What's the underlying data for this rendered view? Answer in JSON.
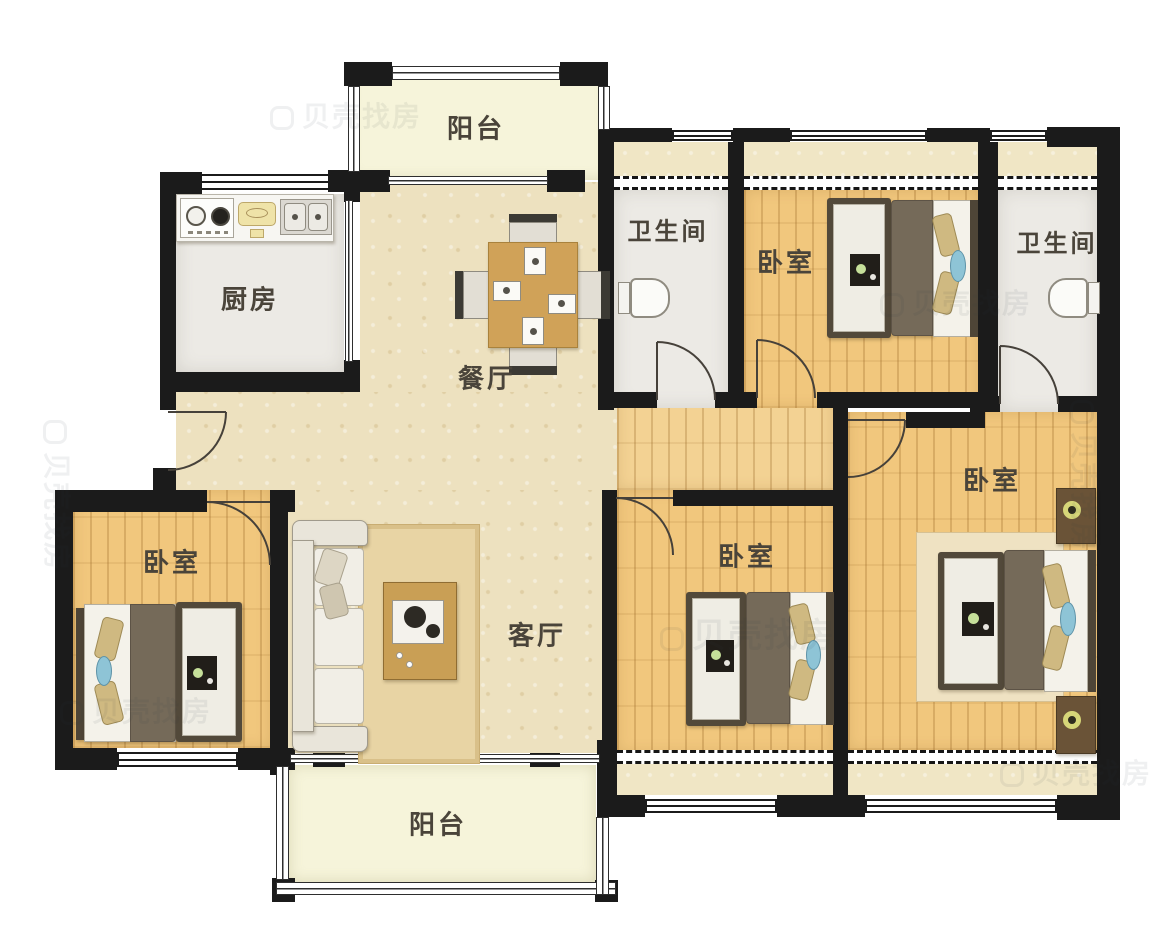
{
  "plan": {
    "type": "apartment-floorplan",
    "rooms": [
      {
        "id": "balcony-top",
        "label": "阳台"
      },
      {
        "id": "kitchen",
        "label": "厨房"
      },
      {
        "id": "dining",
        "label": "餐厅"
      },
      {
        "id": "bathroom-left",
        "label": "卫生间"
      },
      {
        "id": "bedroom-topright",
        "label": "卧室"
      },
      {
        "id": "bathroom-right",
        "label": "卫生间"
      },
      {
        "id": "bedroom-left",
        "label": "卧室"
      },
      {
        "id": "living",
        "label": "客厅"
      },
      {
        "id": "bedroom-middle",
        "label": "卧室"
      },
      {
        "id": "bedroom-right",
        "label": "卧室"
      },
      {
        "id": "balcony-bottom",
        "label": "阳台"
      }
    ],
    "furniture_icons": [
      "double-bed-icon",
      "wardrobe-icon",
      "nightstand-lamp-icon",
      "sofa-icon",
      "coffee-table-icon",
      "rug-icon",
      "dining-table-icon",
      "dining-chair-icon",
      "toilet-icon",
      "kitchen-stove-icon",
      "range-hood-icon",
      "double-sink-icon"
    ],
    "symbols": [
      "door-swing-arc",
      "window-double-line",
      "bay-window-dashed",
      "balcony-railing",
      "sliding-door-line"
    ]
  },
  "watermark": {
    "text": "贝壳找房"
  },
  "palette": {
    "wall": "#1b1b1b",
    "floor_cream": "#ede1bf",
    "floor_wood": "#f1c77d",
    "floor_tile": "#eceae5",
    "floor_balcony": "#f6f4da",
    "floor_bay": "#f0e6c5",
    "label_text": "#4a443a",
    "duvet": "#756a59",
    "pillow_tan": "#cfb981",
    "pillow_blue": "#8ec4d6",
    "table_wood": "#d0a258",
    "hood_yellow": "#efe3a8",
    "lamp_ring": "#d6d678"
  }
}
